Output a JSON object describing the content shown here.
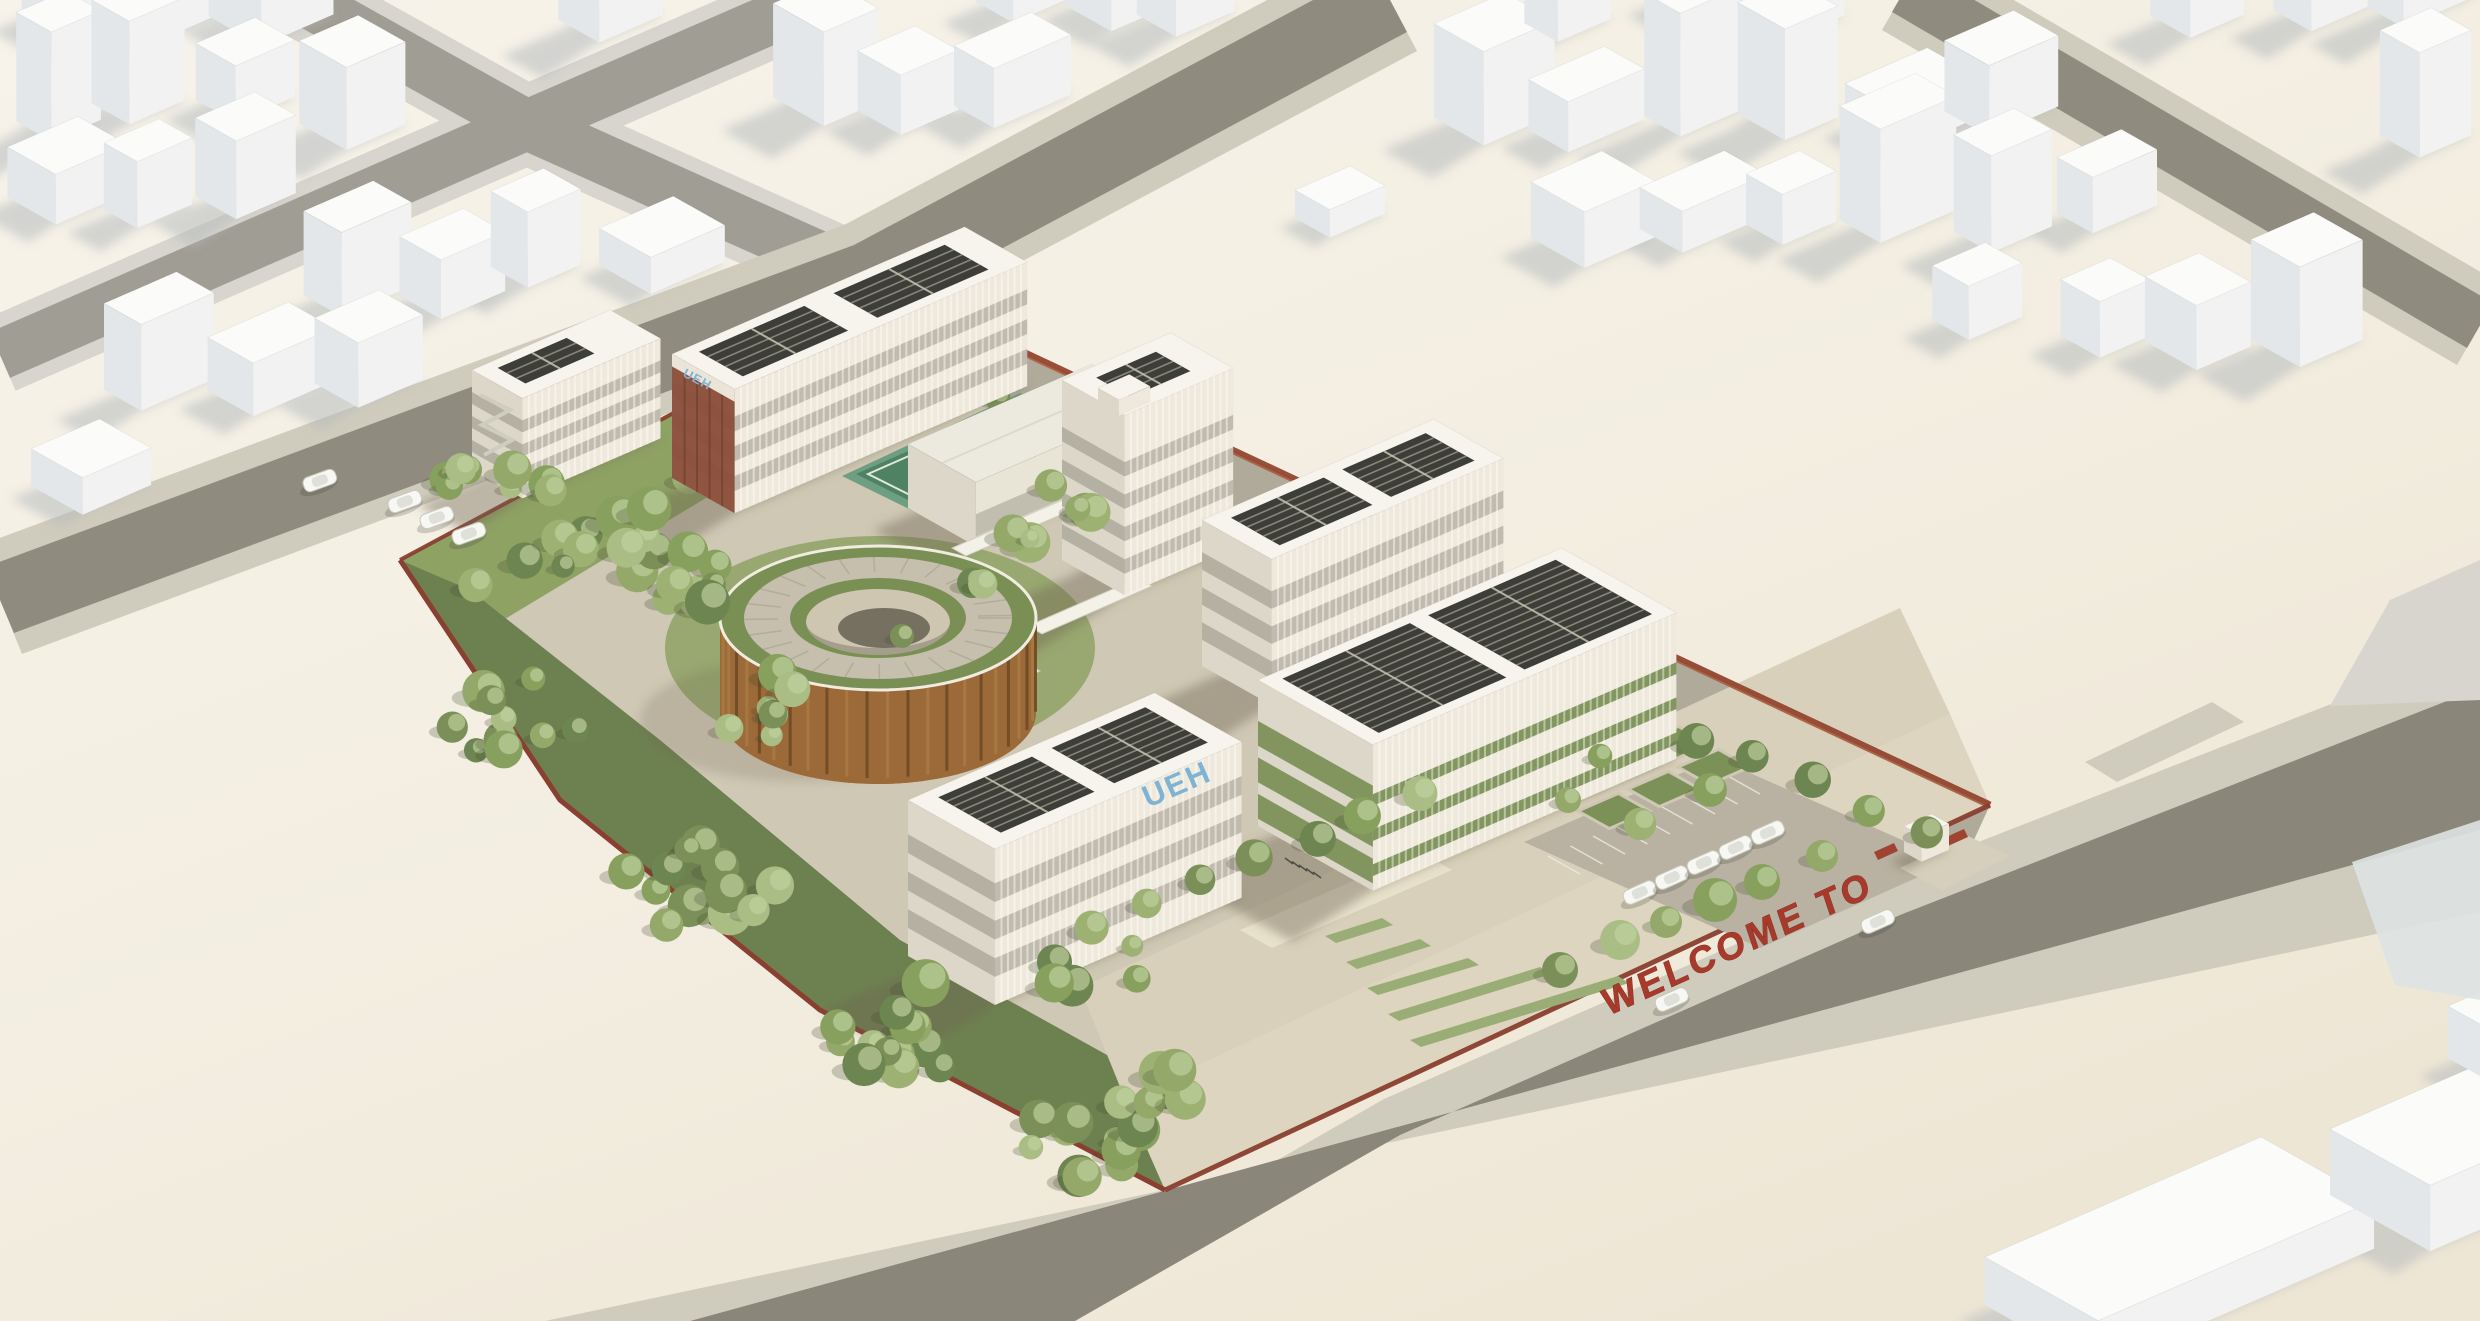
{
  "scene": {
    "type": "architectural-aerial-render",
    "signs": {
      "rooftop_logo": "UEH",
      "gable_logo": "UEH",
      "entrance_welcome": "WELCOME TO"
    },
    "palette": {
      "ground_cream": "#f4efe4",
      "ground_cream_dark": "#eee7d6",
      "road_asphalt": "#8f8b7e",
      "road_asphalt_dark": "#8a867a",
      "road_light": "#a09d94",
      "sidewalk": "#d0ccbd",
      "sidewalk_cool": "#d7d5cd",
      "site_paving": "#cfc8b4",
      "plaza_paving": "#ddd5bf",
      "internal_drive": "#b0aa9b",
      "lawn_green": "#8ea264",
      "forest_green": "#6d8150",
      "hedge_green": "#7c9158",
      "wedge_green": "#9bad76",
      "court_apron": "#6f9f83",
      "court_green": "#4f8263",
      "fence_red": "#8a3f30",
      "fence_tile_red": "#93452f",
      "drum_timber": "#9c6a38",
      "drum_timber_dark": "#6e4a24",
      "brick_end": "#8d4f3b",
      "solar_dark": "#2e2e28",
      "logo_blue": "#7fb3d4",
      "sign_red": "#a83a2c",
      "building_top": "#f6f4ec",
      "building_right": "#eee9dc",
      "building_left": "#dcd7c8",
      "context_top": "#fbfbfa",
      "context_right": "#f1f2f1",
      "context_left": "#e4e7e9",
      "context_shadow": "#b6bbbe",
      "glass_roof_blue": "#dde3e3"
    }
  }
}
